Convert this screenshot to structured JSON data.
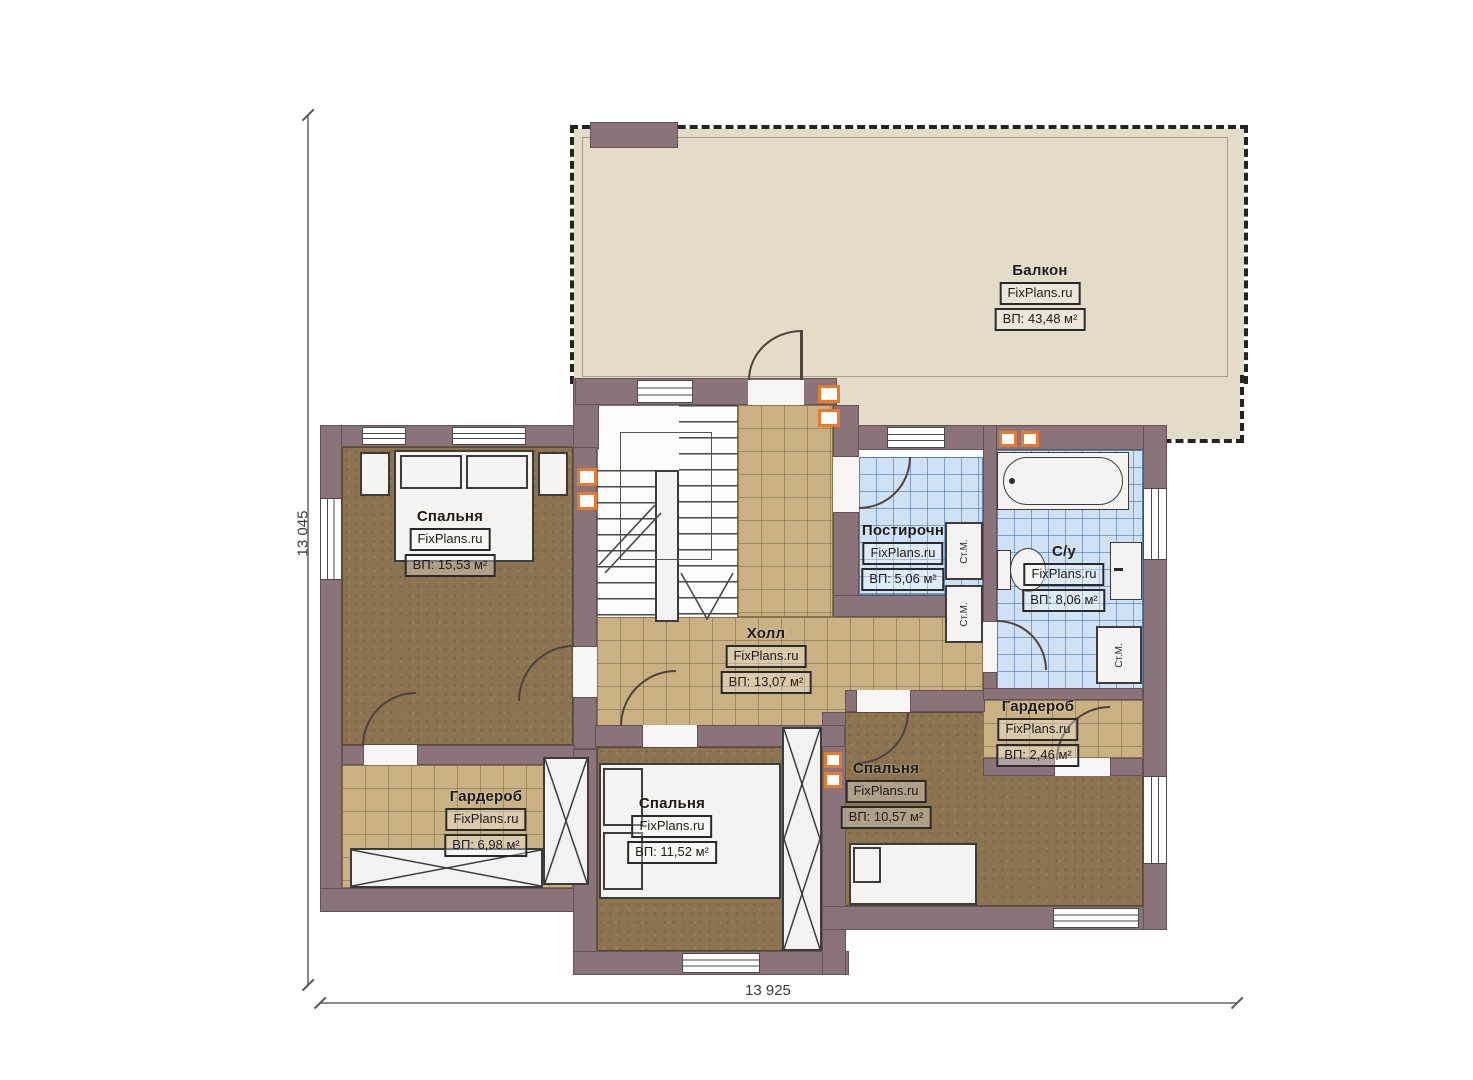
{
  "plan": {
    "watermark": "FixPlans.ru",
    "washer_label": "Ст.М.",
    "dimensions": {
      "left": "13 045",
      "bottom": "13 925"
    },
    "rooms": [
      {
        "id": "balcony",
        "name": "Балкон",
        "area": "ВП: 43,48 м²"
      },
      {
        "id": "bedroom-tl",
        "name": "Спальня",
        "area": "ВП: 15,53 м²"
      },
      {
        "id": "laundry",
        "name": "Постирочн",
        "area": "ВП: 5,06 м²"
      },
      {
        "id": "bathroom",
        "name": "С/у",
        "area": "ВП: 8,06 м²"
      },
      {
        "id": "hall",
        "name": "Холл",
        "area": "ВП: 13,07 м²"
      },
      {
        "id": "wardrobe-small",
        "name": "Гардероб",
        "area": "ВП: 2,46 м²"
      },
      {
        "id": "bedroom-right",
        "name": "Спальня",
        "area": "ВП: 10,57 м²"
      },
      {
        "id": "wardrobe-left",
        "name": "Гардероб",
        "area": "ВП: 6,98 м²"
      },
      {
        "id": "bedroom-bottom",
        "name": "Спальня",
        "area": "ВП: 11,52 м²"
      }
    ],
    "colors": {
      "wall": "#8a747a",
      "wood_floor": "#8b744f",
      "tile_tan": "#c9b184",
      "tile_blue": "#cfe2f5",
      "balcony_floor": "#e4dbc9",
      "vent_accent": "#e87a2c"
    }
  }
}
